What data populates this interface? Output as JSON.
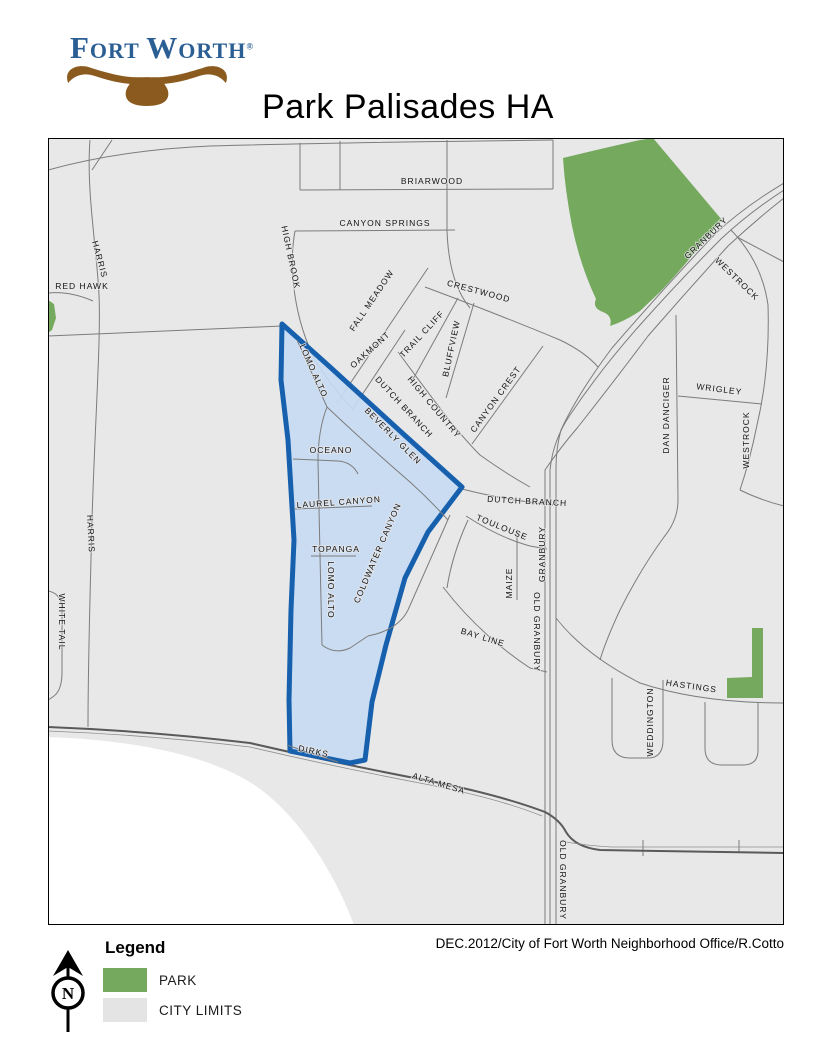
{
  "logo": {
    "word1": "Fort",
    "word2": "Worth",
    "registered": "®"
  },
  "title": "Park Palisades HA",
  "credit": "DEC.2012/City of Fort Worth Neighborhood Office/R.Cotto",
  "legend": {
    "title": "Legend",
    "items": [
      {
        "label": "PARK",
        "color": "#74a95e"
      },
      {
        "label": "CITY LIMITS",
        "color": "#e4e4e4"
      }
    ]
  },
  "north_arrow": {
    "letter": "N"
  },
  "colors": {
    "city_limits_fill": "#e8e8e8",
    "outside_city_fill": "#ffffff",
    "park_green": "#74a95e",
    "ha_fill": "#c7daf2",
    "ha_border": "#1660ae",
    "road_gray": "#7c7c7c",
    "logo_blue": "#2b5f94",
    "longhorn_brown": "#8a5a1e"
  },
  "map": {
    "labels": [
      {
        "text": "BRIARWOOD",
        "x": 432,
        "y": 184,
        "r": 0
      },
      {
        "text": "CANYON SPRINGS",
        "x": 385,
        "y": 226,
        "r": 0
      },
      {
        "text": "HIGH BROOK",
        "x": 288,
        "y": 258,
        "r": 78
      },
      {
        "text": "HARRIS",
        "x": 97,
        "y": 260,
        "r": 75
      },
      {
        "text": "RED HAWK",
        "x": 82,
        "y": 289,
        "r": 0
      },
      {
        "text": "FALL MEADOW",
        "x": 374,
        "y": 302,
        "r": -56
      },
      {
        "text": "OAKMONT",
        "x": 372,
        "y": 352,
        "r": -42
      },
      {
        "text": "TRAIL CLIFF",
        "x": 424,
        "y": 336,
        "r": -47
      },
      {
        "text": "BLUFFVIEW",
        "x": 454,
        "y": 349,
        "r": -78
      },
      {
        "text": "HIGH COUNTRY",
        "x": 432,
        "y": 409,
        "r": 50
      },
      {
        "text": "CANYON CREST",
        "x": 498,
        "y": 401,
        "r": -54
      },
      {
        "text": "CRESTWOOD",
        "x": 478,
        "y": 294,
        "r": 15
      },
      {
        "text": "DUTCH BRANCH",
        "x": 402,
        "y": 409,
        "r": 47
      },
      {
        "text": "LOMO ALTO",
        "x": 311,
        "y": 372,
        "r": 66
      },
      {
        "text": "BEVERLY GLEN",
        "x": 391,
        "y": 438,
        "r": 45
      },
      {
        "text": "OCEANO",
        "x": 331,
        "y": 453,
        "r": 0
      },
      {
        "text": "LAUREL CANYON",
        "x": 339,
        "y": 505,
        "r": -4
      },
      {
        "text": "TOPANGA",
        "x": 336,
        "y": 552,
        "r": 0
      },
      {
        "text": "LOMO ALTO",
        "x": 328,
        "y": 590,
        "r": 90
      },
      {
        "text": "COLDWATER CANYON",
        "x": 380,
        "y": 554,
        "r": -67
      },
      {
        "text": "DUTCH BRANCH",
        "x": 527,
        "y": 504,
        "r": 3
      },
      {
        "text": "TOULOUSE",
        "x": 501,
        "y": 530,
        "r": 22
      },
      {
        "text": "MAIZE",
        "x": 512,
        "y": 583,
        "r": -90
      },
      {
        "text": "GRANBURY",
        "x": 545,
        "y": 554,
        "r": -90
      },
      {
        "text": "OLD GRANBURY",
        "x": 534,
        "y": 632,
        "r": 90
      },
      {
        "text": "OLD GRANBURY",
        "x": 560,
        "y": 880,
        "r": 90
      },
      {
        "text": "GRANBURY",
        "x": 708,
        "y": 240,
        "r": -44
      },
      {
        "text": "WESTROCK",
        "x": 735,
        "y": 281,
        "r": 44
      },
      {
        "text": "WESTROCK",
        "x": 749,
        "y": 440,
        "r": -90
      },
      {
        "text": "DAN DANCIGER",
        "x": 669,
        "y": 415,
        "r": -90
      },
      {
        "text": "WRIGLEY",
        "x": 719,
        "y": 392,
        "r": 7
      },
      {
        "text": "BAY LINE",
        "x": 482,
        "y": 640,
        "r": 17
      },
      {
        "text": "HASTINGS",
        "x": 691,
        "y": 689,
        "r": 8
      },
      {
        "text": "WEDDINGTON",
        "x": 653,
        "y": 722,
        "r": -90
      },
      {
        "text": "HARRIS",
        "x": 88,
        "y": 534,
        "r": 87
      },
      {
        "text": "WHITE TAIL",
        "x": 59,
        "y": 622,
        "r": 90
      },
      {
        "text": "ALTA MESA",
        "x": 438,
        "y": 786,
        "r": 17
      },
      {
        "text": "DIRKS",
        "x": 313,
        "y": 754,
        "r": 12
      }
    ]
  }
}
